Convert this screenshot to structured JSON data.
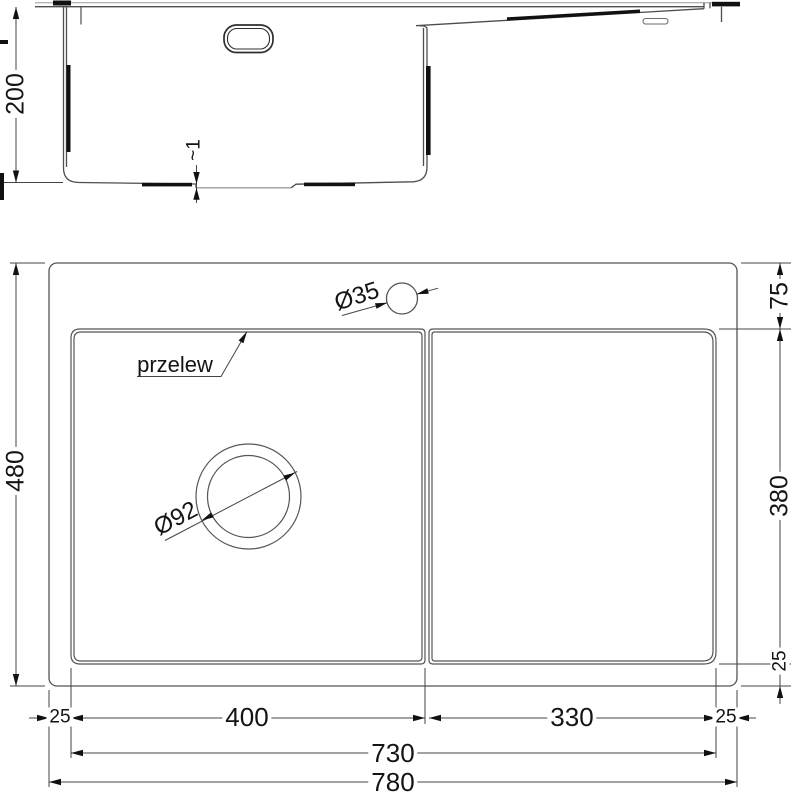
{
  "drawing": {
    "kind": "sink-technical-drawing",
    "colors": {
      "line": "#4d4d4d",
      "line_light": "#9c9c9c",
      "text": "#141414",
      "solid_black": "#111111"
    },
    "section": {
      "depth": "200",
      "bottom_step": "~1"
    },
    "plan": {
      "overflow": "przelew",
      "tap_hole": "Ø35",
      "drain": "Ø92",
      "overall_height": "480",
      "rim_top": "75",
      "bowl_inner_height": "380",
      "rim_bottom": "25",
      "rim_left": "25",
      "bowl_inner_width": "400",
      "drainer_inner_width": "330",
      "rim_right": "25",
      "inner_width": "730",
      "overall_width": "780"
    }
  }
}
